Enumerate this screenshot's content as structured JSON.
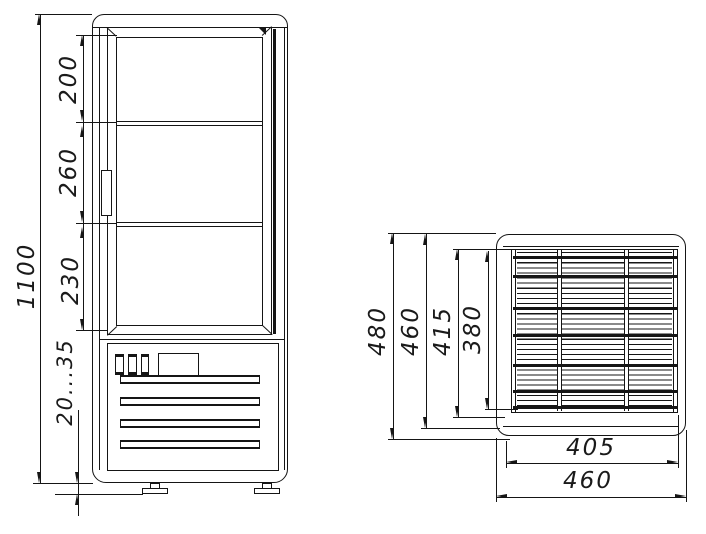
{
  "drawing": {
    "background": "#ffffff",
    "line_color": "#151515",
    "front_view": {
      "dims": {
        "total_height": "1100",
        "top_section": "200",
        "middle_section": "260",
        "bottom_section": "230",
        "foot_adjust_range": "20...35"
      }
    },
    "top_view": {
      "dims": {
        "overall_depth": "480",
        "body_depth": "460",
        "grille_depth": "415",
        "grille_inner_depth": "380",
        "grille_width": "405",
        "overall_width": "460"
      }
    }
  }
}
